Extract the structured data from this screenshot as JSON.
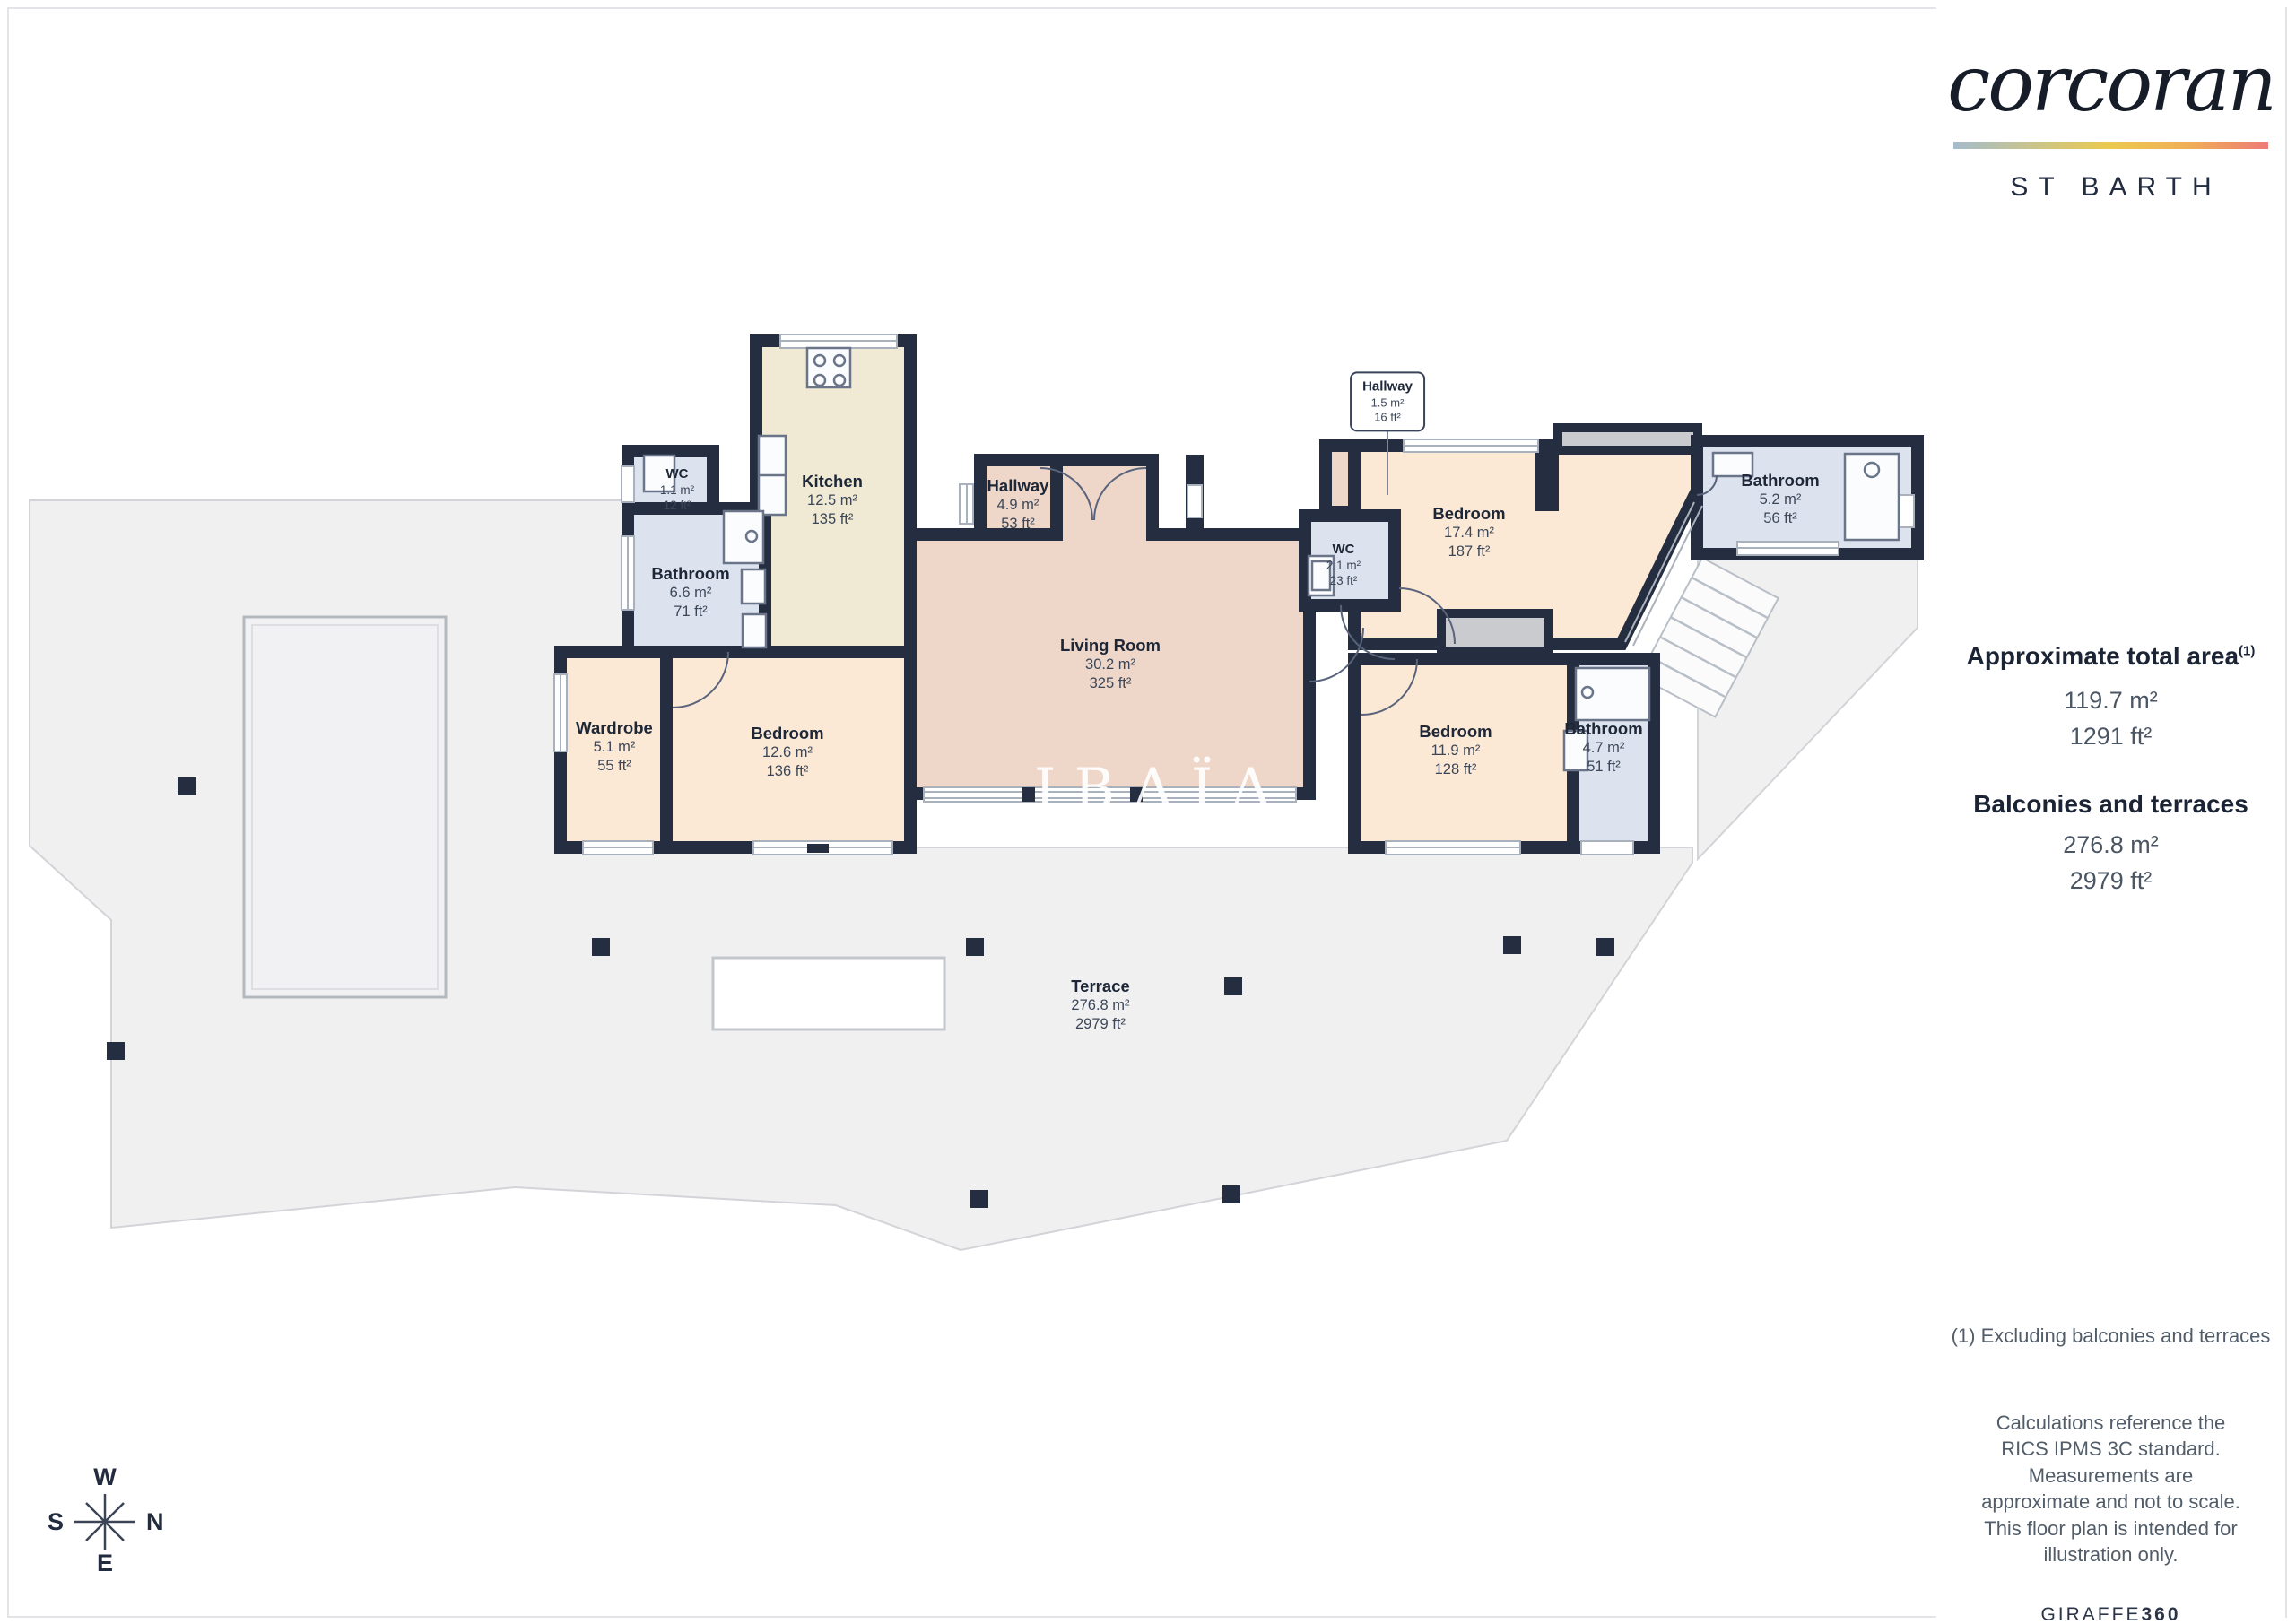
{
  "brand": {
    "logo": "corcoran",
    "location": "ST BARTH"
  },
  "sidebar": {
    "total_area_title": "Approximate total area",
    "total_area_sup": "(1)",
    "total_area_m2": "119.7 m²",
    "total_area_ft2": "1291 ft²",
    "balconies_title": "Balconies and terraces",
    "balconies_m2": "276.8 m²",
    "balconies_ft2": "2979 ft²",
    "footnote": "(1) Excluding balconies and terraces",
    "disclaimer": "Calculations reference the RICS IPMS 3C standard. Measurements are approximate and not to scale. This floor plan is intended for illustration only.",
    "credit_regular": "GIRAFFE",
    "credit_bold": "360"
  },
  "watermark": {
    "line1": "IBAÏA",
    "line2": "IMMOBILIER"
  },
  "compass": {
    "top": "W",
    "right": "N",
    "left": "S",
    "bottom": "E"
  },
  "rooms": {
    "wc_west": {
      "name": "WC",
      "m2": "1.1 m²",
      "ft2": "12 ft²"
    },
    "kitchen": {
      "name": "Kitchen",
      "m2": "12.5 m²",
      "ft2": "135 ft²"
    },
    "bathroom_west": {
      "name": "Bathroom",
      "m2": "6.6 m²",
      "ft2": "71 ft²"
    },
    "hallway_main": {
      "name": "Hallway",
      "m2": "4.9 m²",
      "ft2": "53 ft²"
    },
    "wardrobe": {
      "name": "Wardrobe",
      "m2": "5.1 m²",
      "ft2": "55 ft²"
    },
    "bedroom_west": {
      "name": "Bedroom",
      "m2": "12.6 m²",
      "ft2": "136 ft²"
    },
    "living_room": {
      "name": "Living Room",
      "m2": "30.2 m²",
      "ft2": "325 ft²"
    },
    "hallway_small": {
      "name": "Hallway",
      "m2": "1.5 m²",
      "ft2": "16 ft²"
    },
    "wc_east": {
      "name": "WC",
      "m2": "2.1 m²",
      "ft2": "23 ft²"
    },
    "bedroom_north": {
      "name": "Bedroom",
      "m2": "17.4 m²",
      "ft2": "187 ft²"
    },
    "bathroom_north": {
      "name": "Bathroom",
      "m2": "5.2 m²",
      "ft2": "56 ft²"
    },
    "bedroom_east": {
      "name": "Bedroom",
      "m2": "11.9 m²",
      "ft2": "128 ft²"
    },
    "bathroom_east": {
      "name": "Bathroom",
      "m2": "4.7 m²",
      "ft2": "51 ft²"
    },
    "terrace": {
      "name": "Terrace",
      "m2": "276.8 m²",
      "ft2": "2979 ft²"
    }
  },
  "colors": {
    "wall": "#242e40",
    "peach": "#fce9d5",
    "pink": "#eed6c9",
    "beige": "#f0e9d3",
    "blue": "#dde3ee",
    "terrace": "#f0f0f1",
    "deck": "#cacbce",
    "ink": "#1d2636",
    "divider": "#e3e4e7",
    "brand_gradient": [
      "#a4bccb",
      "#c9c48c",
      "#ecc94e",
      "#efae58",
      "#ee7b76"
    ]
  }
}
